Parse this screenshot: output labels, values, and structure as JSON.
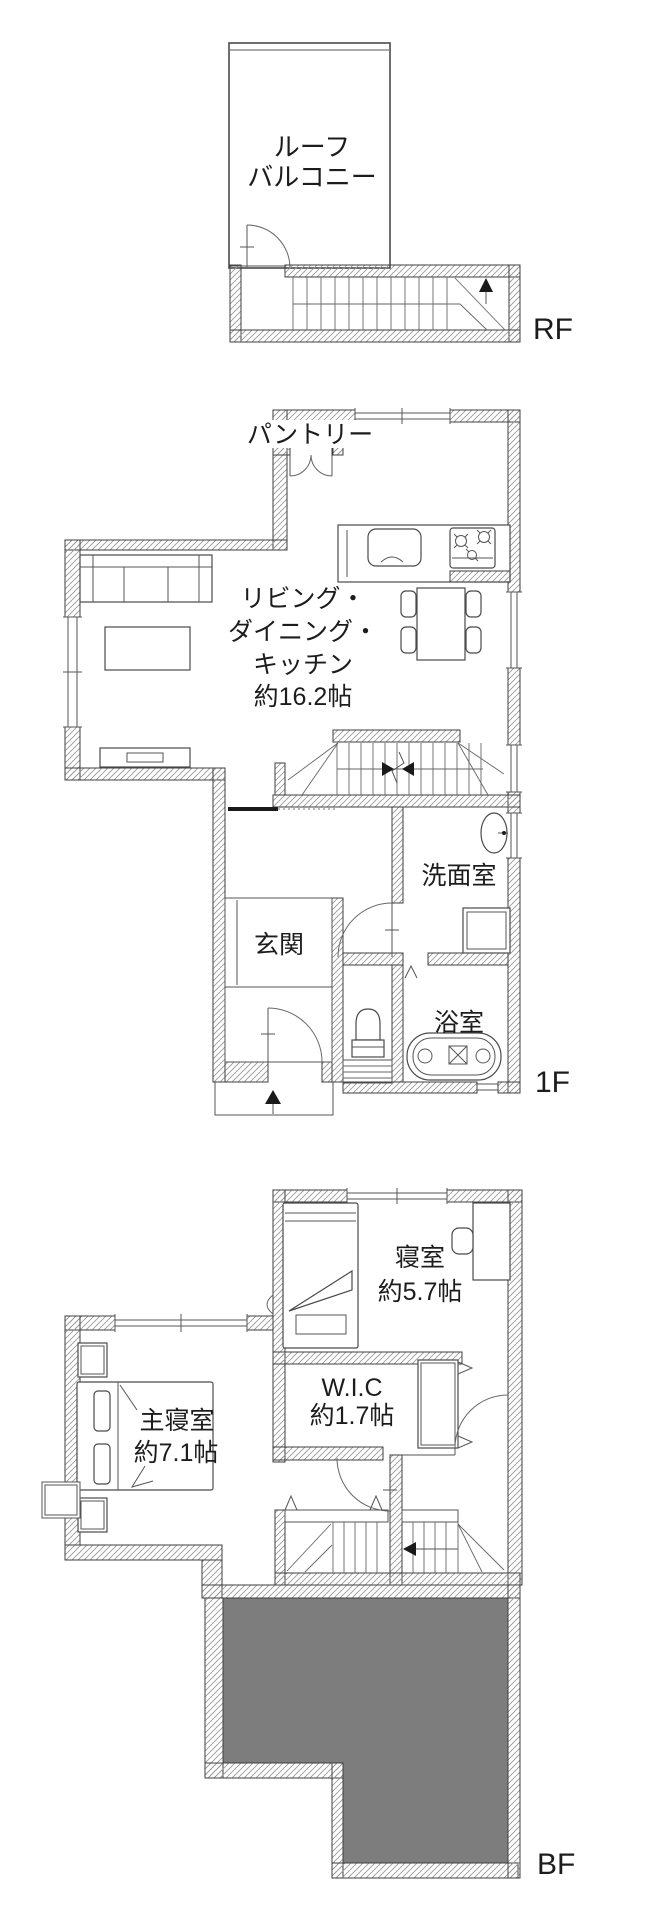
{
  "floors": {
    "rf": {
      "floor_label": "RF",
      "roof_balcony_line1": "ルーフ",
      "roof_balcony_line2": "バルコニー"
    },
    "f1": {
      "floor_label": "1F",
      "pantry": "パントリー",
      "ldk_line1": "リビング・",
      "ldk_line2": "ダイニング・",
      "ldk_line3": "キッチン",
      "ldk_line4": "約16.2帖",
      "entrance": "玄関",
      "washroom": "洗面室",
      "bathroom": "浴室"
    },
    "bf": {
      "floor_label": "BF",
      "bedroom": "寝室",
      "bedroom_size": "約5.7帖",
      "wic": "W.I.C",
      "wic_size": "約1.7帖",
      "master_bedroom": "主寝室",
      "master_bedroom_size": "約7.1帖"
    }
  },
  "colors": {
    "wall_line": "#3f3f3f",
    "hatch_line": "#9a9a9a",
    "text": "#1c1c1c",
    "gray_fill": "#7d7d7d",
    "background": "#ffffff"
  }
}
